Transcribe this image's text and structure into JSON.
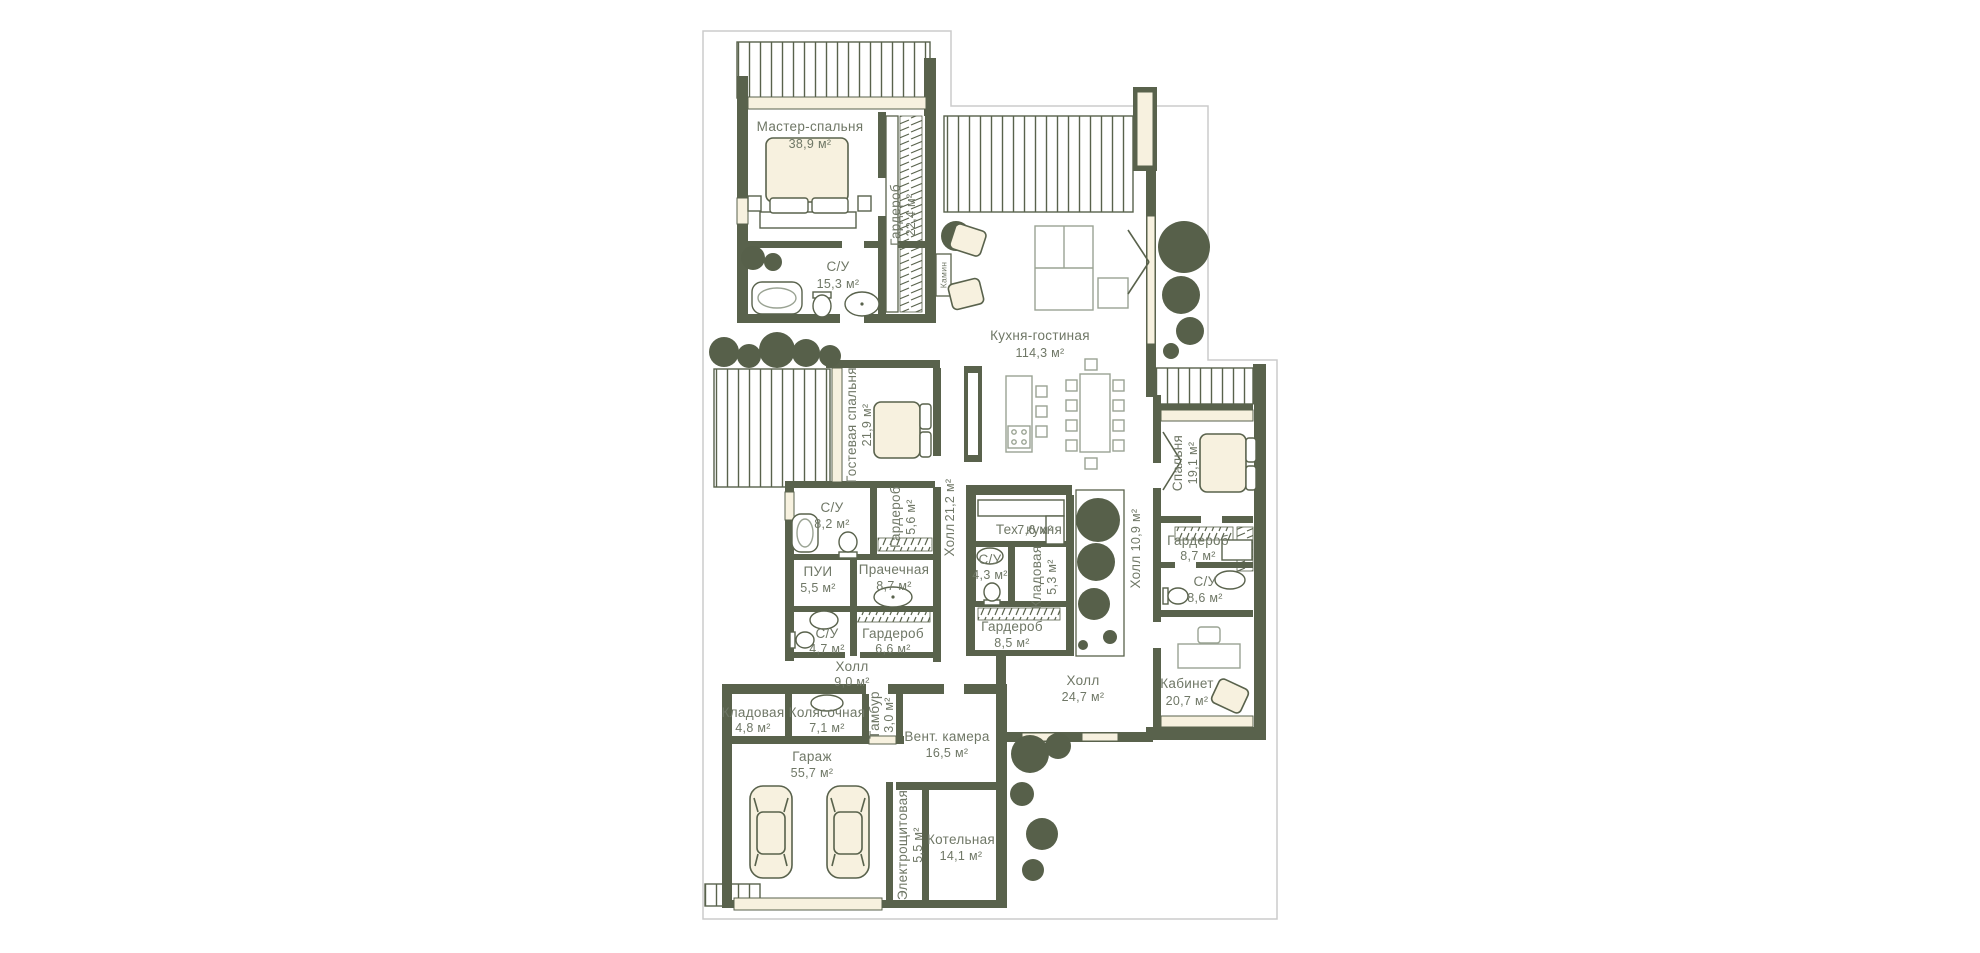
{
  "plan": {
    "rooms": [
      {
        "name": "Мастер-спальня",
        "area": "38,9 м²"
      },
      {
        "name": "С/У",
        "area": "15,3 м²"
      },
      {
        "name": "Гардероб",
        "area": "22,4 м²"
      },
      {
        "name": "Кухня-гостиная",
        "area": "114,3 м²"
      },
      {
        "name": "Гостевая спальня",
        "area": "21,9 м²"
      },
      {
        "name": "С/У",
        "area": "8,2 м²"
      },
      {
        "name": "Гардероб",
        "area": "5,6 м²"
      },
      {
        "name": "Холл",
        "area": "21,2 м²"
      },
      {
        "name": "Тех. кухня",
        "area": "7,6 м²"
      },
      {
        "name": "С/У",
        "area": "4,3 м²"
      },
      {
        "name": "Кладовая",
        "area": "5,3 м²"
      },
      {
        "name": "Холл",
        "area": "10,9 м²"
      },
      {
        "name": "Спальня",
        "area": "19,1 м²"
      },
      {
        "name": "Гардероб",
        "area": "8,7 м²"
      },
      {
        "name": "С/У",
        "area": "8,6 м²"
      },
      {
        "name": "Кабинет",
        "area": "20,7 м²"
      },
      {
        "name": "ПУИ",
        "area": "5,5 м²"
      },
      {
        "name": "Прачечная",
        "area": "8,7 м²"
      },
      {
        "name": "С/У",
        "area": "4,7 м²"
      },
      {
        "name": "Гардероб",
        "area": "6,6 м²"
      },
      {
        "name": "Холл",
        "area": "9,0 м²"
      },
      {
        "name": "Гардероб",
        "area": "8,5 м²"
      },
      {
        "name": "Холл",
        "area": "24,7 м²"
      },
      {
        "name": "Кладовая",
        "area": "4,8 м²"
      },
      {
        "name": "Колясочная",
        "area": "7,1 м²"
      },
      {
        "name": "Тамбур",
        "area": "3,0 м²"
      },
      {
        "name": "Вент. камера",
        "area": "16,5 м²"
      },
      {
        "name": "Гараж",
        "area": "55,7 м²"
      },
      {
        "name": "Электрощитовая",
        "area": "5,5 м²"
      },
      {
        "name": "Котельная",
        "area": "14,1 м²"
      }
    ],
    "fireplace_label": "Камин",
    "colors": {
      "wall": "#59624c",
      "text": "#6f7766",
      "cream": "#f7f1df",
      "tree": "#57604a",
      "furn": "#9aa393",
      "boundary": "#cbcbcb",
      "bg": "#ffffff"
    }
  }
}
